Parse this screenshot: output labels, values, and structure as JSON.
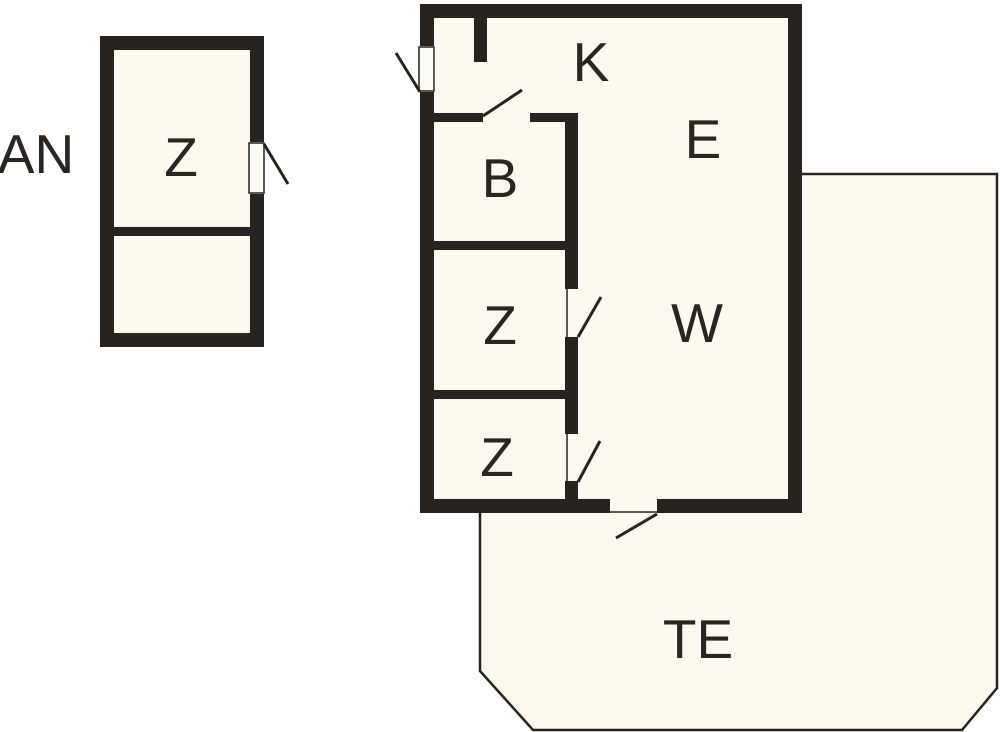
{
  "floorplan": {
    "labels": {
      "annex": "AN",
      "annex_room": "Z",
      "kitchen": "K",
      "bathroom": "B",
      "entry": "E",
      "bedroom_middle": "Z",
      "living_room": "W",
      "bedroom_lower": "Z",
      "terrace": "TE"
    },
    "colors": {
      "wall": "#272320",
      "floor": "#faf8ef",
      "background": "#ffffff",
      "text": "#2a2521"
    }
  }
}
